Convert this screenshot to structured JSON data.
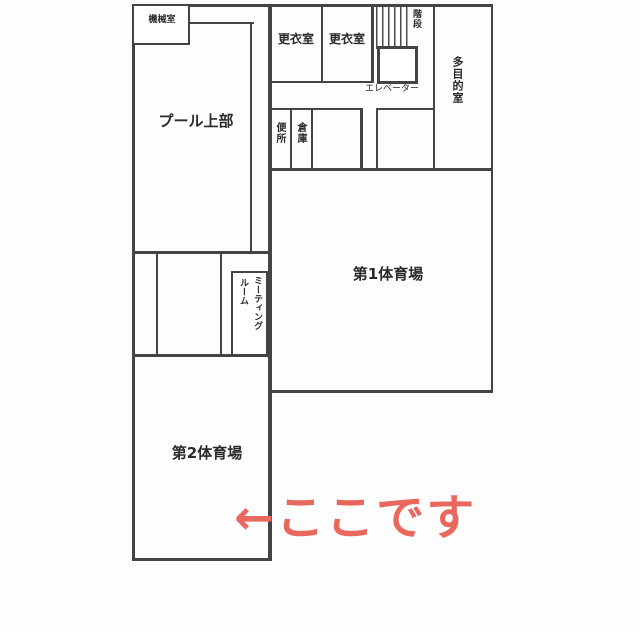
{
  "floor_plan": {
    "machine_room": "機械室",
    "pool_upper": "プール上部",
    "locker_room_1": "更衣室",
    "locker_room_2": "更衣室",
    "stairs": "階段",
    "elevator": "エレベーター",
    "multipurpose_room": "多目的室",
    "toilet": "便所",
    "storage": "倉庫",
    "gym_1": "第1体育場",
    "meeting_room_line_1": "ミーティング",
    "meeting_room_line_2": "ルーム",
    "gym_2": "第2体育場"
  },
  "annotation": {
    "text": "←ここです",
    "color": "#e8685e"
  },
  "colors": {
    "wall": "#444444",
    "background": "#fdfdfd",
    "label_text": "#2a2a2a"
  }
}
